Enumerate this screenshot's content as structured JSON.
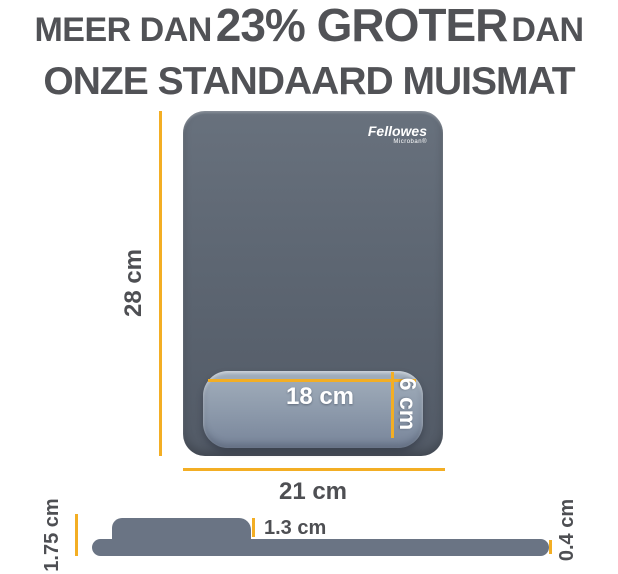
{
  "title": {
    "line1_prefix": "MEER DAN",
    "line1_emphasis": "23% GROTER",
    "line1_suffix": "DAN",
    "line2": "ONZE STANDAARD MUISMAT"
  },
  "brand": {
    "name": "Fellowes",
    "technology": "Microban®"
  },
  "top_view": {
    "height_label": "28 cm",
    "width_label": "21 cm",
    "wrist_rest": {
      "width_label": "18 cm",
      "height_label": "6 cm"
    }
  },
  "side_view": {
    "total_height_label": "1.75 cm",
    "wrist_rest_height_label": "1.3 cm",
    "mat_thickness_label": "0.4 cm"
  },
  "colors": {
    "accent_yellow": "#F3AE24",
    "heading_gray": "#515256",
    "label_gray": "#4E4F53",
    "pad_gray": "#5D6672",
    "wrist_gray": "#8E9BAC",
    "profile_gray": "#6A7484"
  }
}
